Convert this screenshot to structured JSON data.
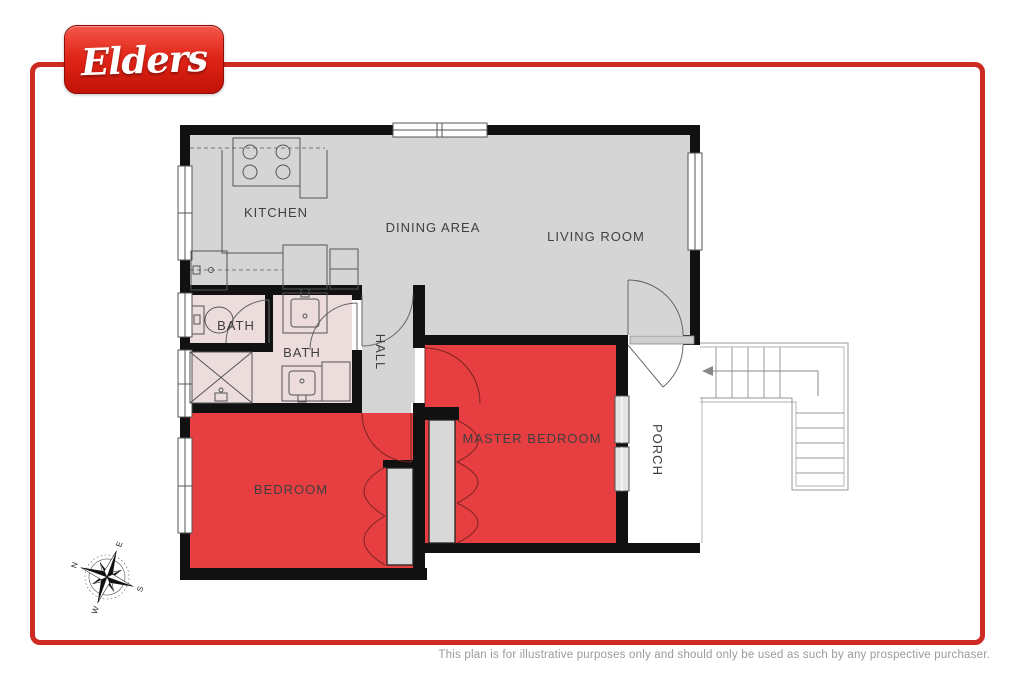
{
  "logo": {
    "text": "Elders"
  },
  "colors": {
    "brand_red": "#e02417",
    "frame_red": "#cd2a22",
    "wall_black": "#111111",
    "floor_gray": "#d5d5d5",
    "bath_pink": "#ecdcdc",
    "room_red": "#e73f41",
    "label_gray": "#3f3f3f"
  },
  "floorplan": {
    "rooms": {
      "kitchen": "KITCHEN",
      "dining": "DINING AREA",
      "living": "LIVING ROOM",
      "bath1": "BATH",
      "bath2": "BATH",
      "hall": "HALL",
      "master": "MASTER BEDROOM",
      "bedroom": "BEDROOM",
      "porch": "PORCH"
    }
  },
  "compass": {
    "n": "N",
    "e": "E",
    "s": "S",
    "w": "W"
  },
  "footer": {
    "disclaimer": "This plan is for illustrative purposes only and should only be used as such by any prospective purchaser."
  }
}
